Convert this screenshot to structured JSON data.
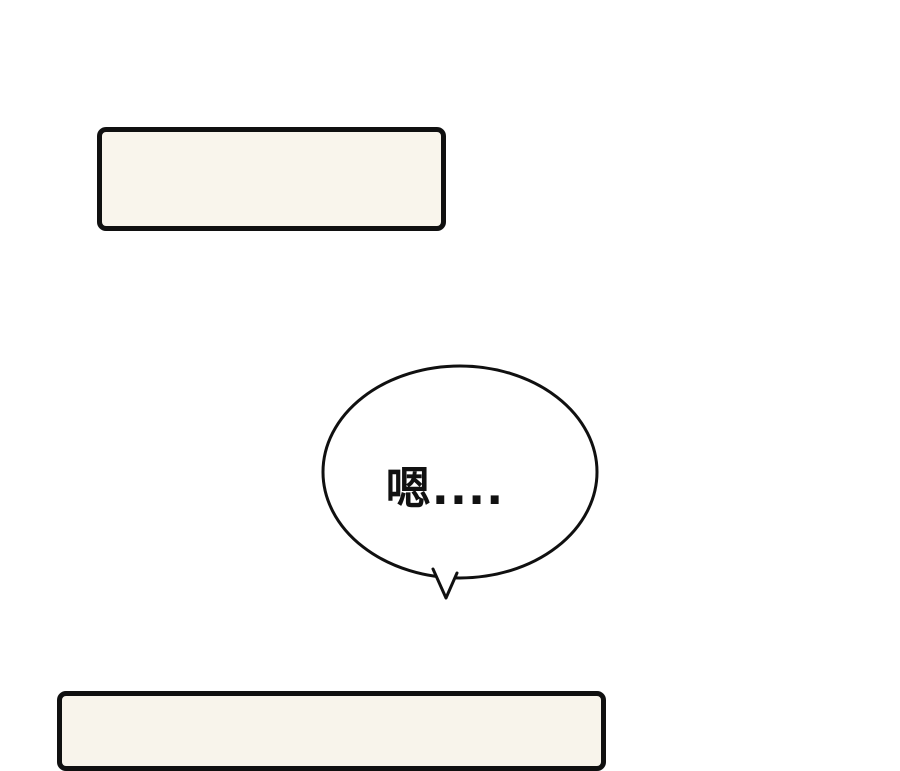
{
  "page": {
    "background_color": "#ffffff",
    "ink_color": "#101010"
  },
  "top_caption_box": {
    "text": "",
    "fill_color": "#f9f5ec"
  },
  "speech_bubble": {
    "text": "嗯....",
    "fill_color": "#ffffff",
    "outline_color": "#101010"
  },
  "bottom_caption_box": {
    "text": "",
    "fill_color": "#f8f4eb"
  }
}
